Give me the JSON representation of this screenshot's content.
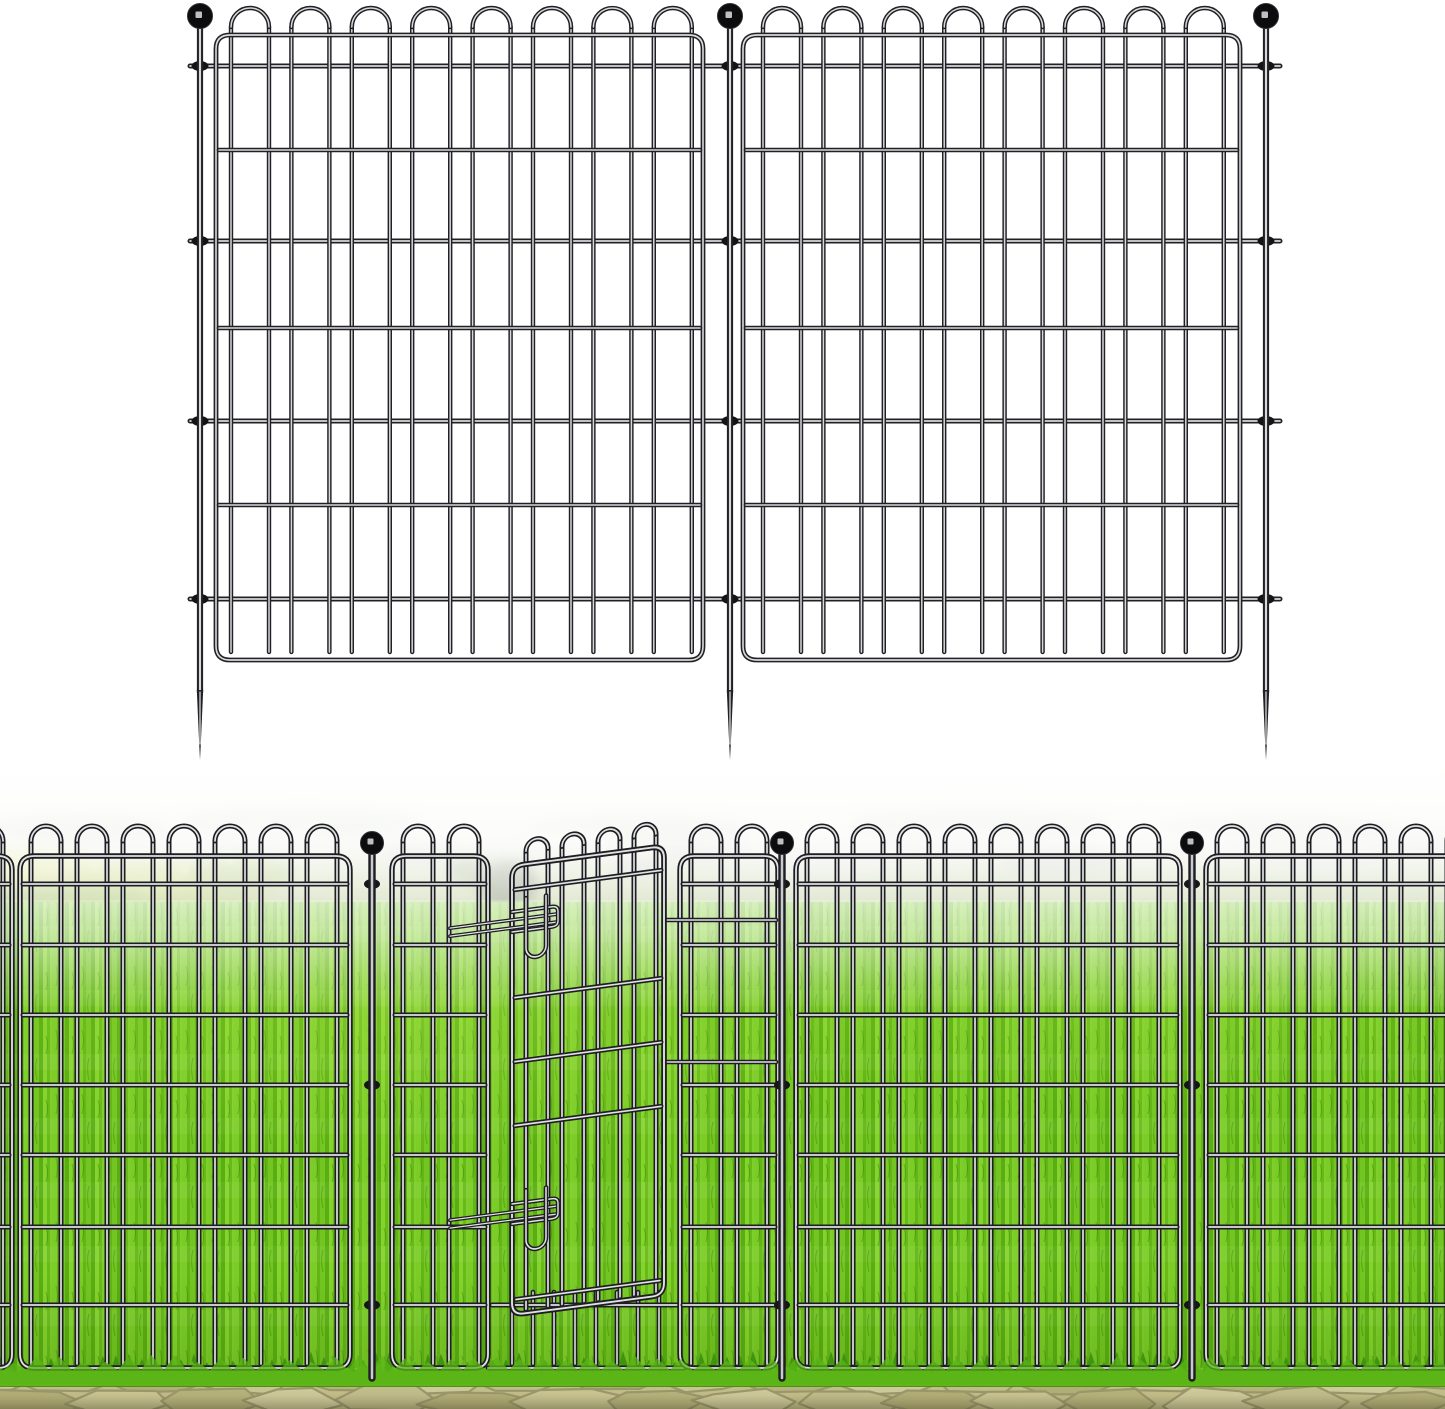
{
  "scene": {
    "description": "Product image of a black metal no-dig garden border fence: two looped-top wire panels with three ball-finial ground stakes shown as a drawing on white above, and the fence installed across a bright green lawn with a slightly open walk-through gate and a stone paver path below"
  },
  "product_illustration": {
    "panel_count": 2,
    "ground_stake_count": 3,
    "stake_finial": "ball",
    "stake_tip": "spike",
    "panel_style": "looped-top welded wire grid"
  },
  "installed_scene": {
    "post_count": 3,
    "post_finial": "ball",
    "gate_count": 1,
    "gate_state": "ajar",
    "gate_latch_count": 2,
    "foreground": "stone pavers",
    "midground": "bright green lawn",
    "background": "foggy meadow with rocks and shrubs"
  },
  "colors": {
    "background": "#ffffff",
    "wire_dark": "#212125",
    "wire_light": "#d8d8db",
    "scene_wire_dark": "#1e1e22",
    "scene_wire_light": "#dfe1e3",
    "finial": "#0c0c0e",
    "finial_glint": "#bfbfc3",
    "lawn_base": "#6fc21d",
    "lawn_light": "#85d22d",
    "lawn_dark": "#5cae14",
    "meadow_top": "#f2f4ec",
    "meadow_mid": "#c9d2ae",
    "meadow_low": "#93b25e",
    "rock_light": "#cccec2",
    "rock_mid": "#aeb1a2",
    "hedge": "#7a9154",
    "bush_yellow": "#c9d254",
    "bush_green": "#8fb445",
    "bush_dark": "#4d6040",
    "paver_base": "#cfca94",
    "paver_light": "#dcd7a8",
    "paver_mid": "#cdc896",
    "paver_dark": "#bdb881",
    "paver_pale": "#d6d19e",
    "paver_joint": "#a29d72",
    "fringe_dark": "#3e9110",
    "fringe_light": "#67bd1c",
    "tuft_front": "#5ab515",
    "fog": "#ffffff"
  }
}
